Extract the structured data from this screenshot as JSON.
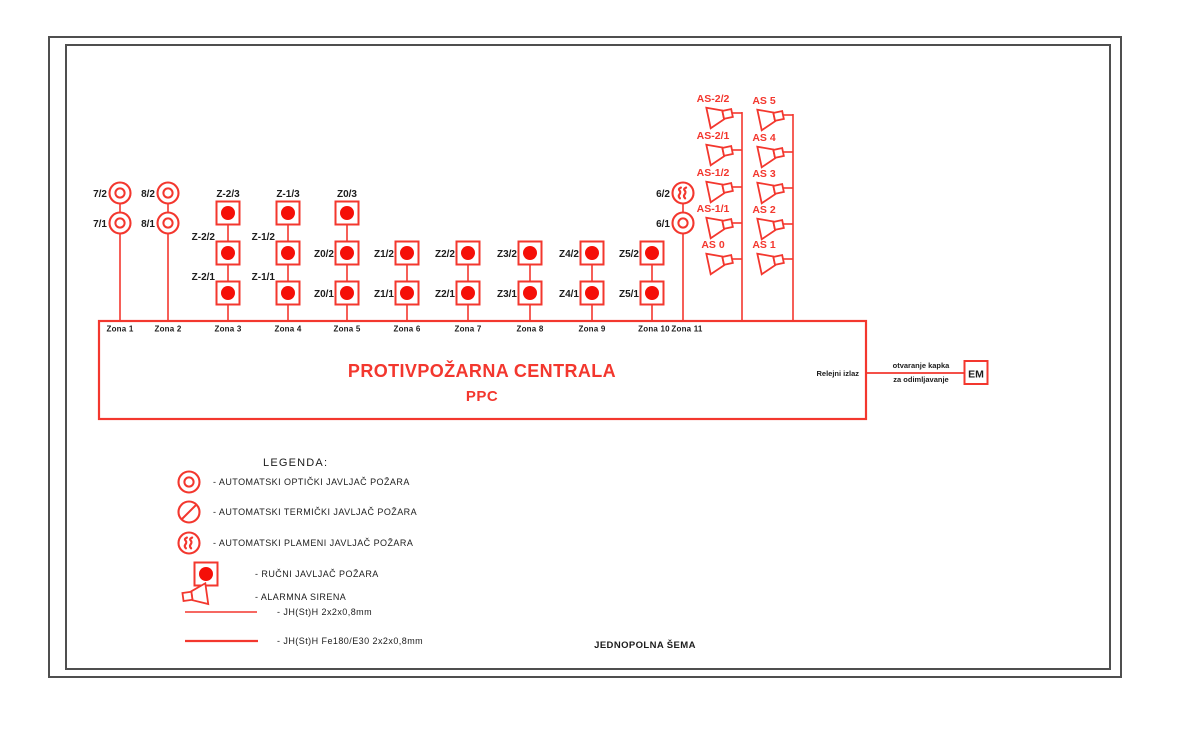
{
  "colors": {
    "red": "#f3372e",
    "red_fill": "#f50f08",
    "ink": "#1c1c1c",
    "frame": "#4f4f4f"
  },
  "ppc": {
    "title": "PROTIVPOŽARNA CENTRALA",
    "subtitle": "PPC"
  },
  "relay": {
    "label": "Relejni izlaz",
    "wire_text_1": "otvaranje kapka",
    "wire_text_2": "za odimljavanje",
    "device": "EM"
  },
  "footer": "JEDNOPOLNA ŠEMA",
  "zones": [
    {
      "name": "Zona 1",
      "x": 120,
      "label_dx": 0,
      "devices": [
        {
          "label": "7/2",
          "symbol": "optical",
          "y": 193,
          "label_pos": "left"
        },
        {
          "label": "7/1",
          "symbol": "optical",
          "y": 223,
          "label_pos": "left"
        }
      ]
    },
    {
      "name": "Zona 2",
      "x": 168,
      "label_dx": 0,
      "devices": [
        {
          "label": "8/2",
          "symbol": "optical",
          "y": 193,
          "label_pos": "left"
        },
        {
          "label": "8/1",
          "symbol": "optical",
          "y": 223,
          "label_pos": "left"
        }
      ]
    },
    {
      "name": "Zona 3",
      "x": 228,
      "label_dx": 0,
      "devices": [
        {
          "label": "Z-2/3",
          "symbol": "manual",
          "y": 213,
          "label_pos": "above"
        },
        {
          "label": "Z-2/2",
          "symbol": "manual",
          "y": 253,
          "label_pos": "left-above"
        },
        {
          "label": "Z-2/1",
          "symbol": "manual",
          "y": 293,
          "label_pos": "left-above"
        }
      ]
    },
    {
      "name": "Zona 4",
      "x": 288,
      "label_dx": 0,
      "devices": [
        {
          "label": "Z-1/3",
          "symbol": "manual",
          "y": 213,
          "label_pos": "above"
        },
        {
          "label": "Z-1/2",
          "symbol": "manual",
          "y": 253,
          "label_pos": "left-above"
        },
        {
          "label": "Z-1/1",
          "symbol": "manual",
          "y": 293,
          "label_pos": "left-above"
        }
      ]
    },
    {
      "name": "Zona 5",
      "x": 347,
      "label_dx": 0,
      "devices": [
        {
          "label": "Z0/3",
          "symbol": "manual",
          "y": 213,
          "label_pos": "above"
        },
        {
          "label": "Z0/2",
          "symbol": "manual",
          "y": 253,
          "label_pos": "left"
        },
        {
          "label": "Z0/1",
          "symbol": "manual",
          "y": 293,
          "label_pos": "left"
        }
      ]
    },
    {
      "name": "Zona 6",
      "x": 407,
      "label_dx": 0,
      "devices": [
        {
          "label": "Z1/2",
          "symbol": "manual",
          "y": 253,
          "label_pos": "left"
        },
        {
          "label": "Z1/1",
          "symbol": "manual",
          "y": 293,
          "label_pos": "left"
        }
      ]
    },
    {
      "name": "Zona 7",
      "x": 468,
      "label_dx": 0,
      "devices": [
        {
          "label": "Z2/2",
          "symbol": "manual",
          "y": 253,
          "label_pos": "left"
        },
        {
          "label": "Z2/1",
          "symbol": "manual",
          "y": 293,
          "label_pos": "left"
        }
      ]
    },
    {
      "name": "Zona 8",
      "x": 530,
      "label_dx": 0,
      "devices": [
        {
          "label": "Z3/2",
          "symbol": "manual",
          "y": 253,
          "label_pos": "left"
        },
        {
          "label": "Z3/1",
          "symbol": "manual",
          "y": 293,
          "label_pos": "left"
        }
      ]
    },
    {
      "name": "Zona 9",
      "x": 592,
      "label_dx": 0,
      "devices": [
        {
          "label": "Z4/2",
          "symbol": "manual",
          "y": 253,
          "label_pos": "left"
        },
        {
          "label": "Z4/1",
          "symbol": "manual",
          "y": 293,
          "label_pos": "left"
        }
      ]
    },
    {
      "name": "Zona 10",
      "x": 652,
      "label_dx": 2,
      "devices": [
        {
          "label": "Z5/2",
          "symbol": "manual",
          "y": 253,
          "label_pos": "left"
        },
        {
          "label": "Z5/1",
          "symbol": "manual",
          "y": 293,
          "label_pos": "left"
        }
      ]
    },
    {
      "name": "Zona 11",
      "x": 683,
      "label_dx": 4,
      "devices": [
        {
          "label": "6/2",
          "symbol": "flame",
          "y": 193,
          "label_pos": "left"
        },
        {
          "label": "6/1",
          "symbol": "optical",
          "y": 223,
          "label_pos": "left"
        }
      ]
    }
  ],
  "zone_bus_y": 321,
  "ppc_box": {
    "x": 99,
    "y": 321,
    "w": 767,
    "h": 98
  },
  "sirens": {
    "buses": [
      {
        "x": 742,
        "top": 112,
        "items": [
          {
            "label": "AS-2/2",
            "y": 113
          },
          {
            "label": "AS-2/1",
            "y": 150
          },
          {
            "label": "AS-1/2",
            "y": 187
          },
          {
            "label": "AS-1/1",
            "y": 223
          },
          {
            "label": "AS 0",
            "y": 259
          }
        ]
      },
      {
        "x": 793,
        "top": 114,
        "items": [
          {
            "label": "AS 5",
            "y": 115
          },
          {
            "label": "AS 4",
            "y": 152
          },
          {
            "label": "AS 3",
            "y": 188
          },
          {
            "label": "AS 2",
            "y": 224
          },
          {
            "label": "AS 1",
            "y": 259
          }
        ]
      }
    ]
  },
  "relay_wire": {
    "x1": 866,
    "x2": 964,
    "y": 373
  },
  "em_box": {
    "x": 964.5,
    "y": 361,
    "w": 23,
    "h": 23
  },
  "legend": {
    "title": "LEGENDA:",
    "items": [
      {
        "symbol": "optical",
        "text": "- AUTOMATSKI OPTIČKI JAVLJAČ POŽARA",
        "sym_x": 189,
        "y": 482,
        "text_x": 213
      },
      {
        "symbol": "thermal",
        "text": "- AUTOMATSKI TERMIČKI JAVLJAČ POŽARA",
        "sym_x": 189,
        "y": 512,
        "text_x": 213
      },
      {
        "symbol": "flame",
        "text": "- AUTOMATSKI PLAMENI JAVLJAČ POŽARA",
        "sym_x": 189,
        "y": 543,
        "text_x": 213
      },
      {
        "symbol": "manual",
        "text": "- RUČNI JAVLJAČ POŽARA",
        "sym_x": 206,
        "y": 574,
        "text_x": 255
      },
      {
        "symbol": "siren",
        "text": "- ALARMNA SIRENA",
        "sym_x": 183,
        "y": 597,
        "text_x": 255
      },
      {
        "symbol": "wire-thin",
        "text": "- JH(St)H 2x2x0,8mm",
        "sym_x": 185,
        "y": 612,
        "text_x": 277,
        "line_end": 257
      },
      {
        "symbol": "wire-thick",
        "text": "- JH(St)H Fe180/E30 2x2x0,8mm",
        "sym_x": 185,
        "y": 641,
        "text_x": 277,
        "line_end": 258
      }
    ]
  }
}
